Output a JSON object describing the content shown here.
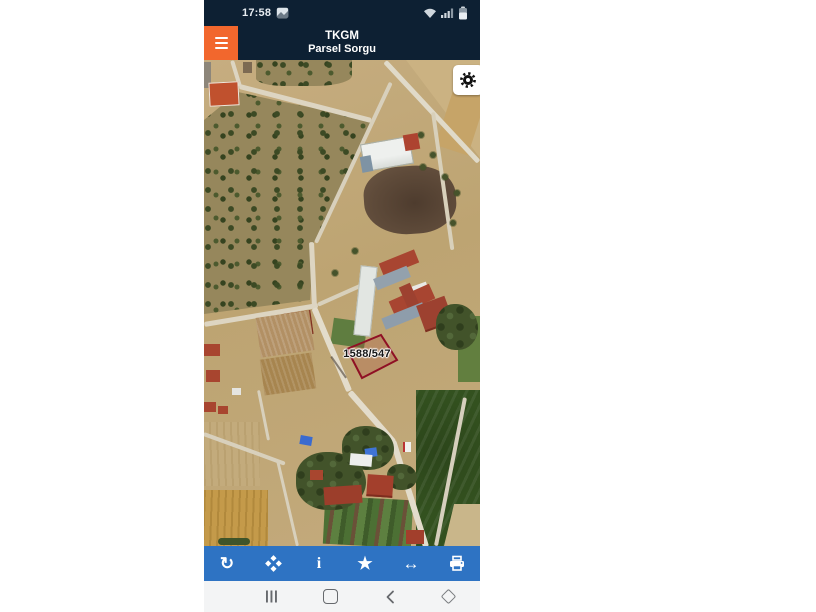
{
  "app": {
    "status_bar": {
      "time": "17:58",
      "icons": [
        "screenshot-icon",
        "wifi-icon",
        "signal-icon",
        "battery-icon"
      ]
    },
    "header": {
      "title_line1": "TKGM",
      "title_line2": "Parsel Sorgu",
      "menu_icon": "hamburger-menu-icon"
    },
    "map": {
      "parcel_label": "1588/547",
      "settings_icon": "gear-icon"
    },
    "toolbar": {
      "items": [
        {
          "name": "refresh",
          "icon": "refresh-icon",
          "glyph": "↻"
        },
        {
          "name": "center-location",
          "icon": "center-diamond-icon",
          "glyph": ""
        },
        {
          "name": "info",
          "icon": "info-icon",
          "glyph": "i"
        },
        {
          "name": "favorite",
          "icon": "star-icon",
          "glyph": "★"
        },
        {
          "name": "measure",
          "icon": "measure-arrow-icon",
          "glyph": "↔"
        },
        {
          "name": "print",
          "icon": "printer-icon",
          "glyph": ""
        }
      ]
    },
    "navbar": {
      "items": [
        "recent-apps",
        "home",
        "back",
        "window-diamond"
      ]
    }
  },
  "colors": {
    "header_navy": "#0d2033",
    "accent_orange": "#f2672d",
    "toolbar_blue": "#2e73c3",
    "parcel_red": "#8f1024",
    "navbar_gray": "#f3f4f5"
  }
}
